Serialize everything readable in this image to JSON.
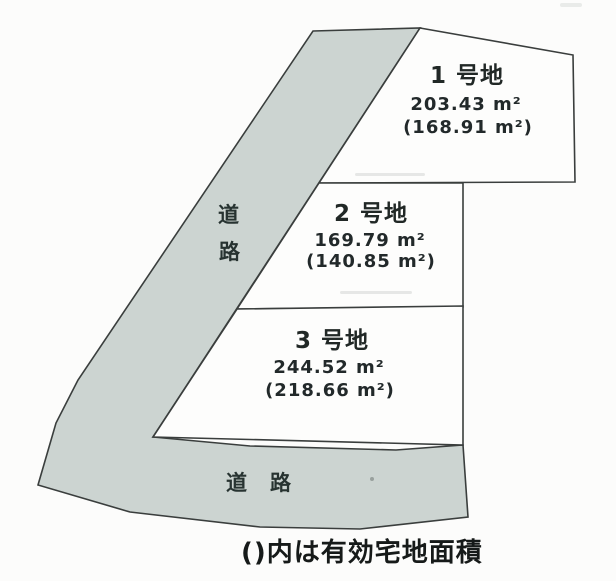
{
  "caption": "()内は有効宅地面積",
  "roads": {
    "side_road_vertical_chars": [
      "道",
      "路"
    ],
    "bottom_road_label": "道　路"
  },
  "plots": [
    {
      "name": "1 号地",
      "area": "203.43 m²",
      "effective_area": "(168.91 m²)"
    },
    {
      "name": "2 号地",
      "area": "169.79 m²",
      "effective_area": "(140.85 m²)"
    },
    {
      "name": "3 号地",
      "area": "244.52 m²",
      "effective_area": "(218.66 m²)"
    }
  ],
  "colors": {
    "road_fill": "#ccd4d1",
    "outline": "#3a3e3d",
    "text": "#212826",
    "background": "#fcfcfb"
  }
}
